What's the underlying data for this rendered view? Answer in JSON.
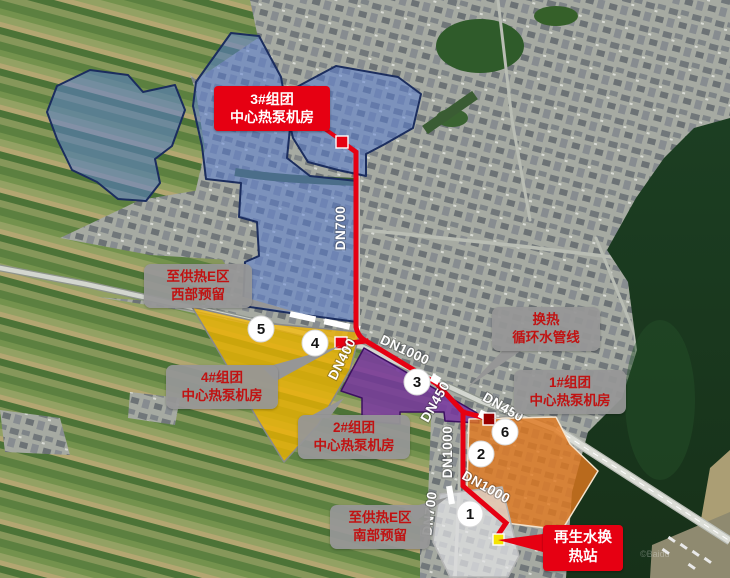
{
  "map": {
    "watermark": "©Baidu",
    "callouts": {
      "hub3": {
        "line1": "3#组团",
        "line2": "中心热泵机房"
      },
      "west_reserved": {
        "line1": "至供热E区",
        "line2": "西部预留"
      },
      "exchange_loop": {
        "line1": "换热",
        "line2": "循环水管线"
      },
      "hub1": {
        "line1": "1#组团",
        "line2": "中心热泵机房"
      },
      "hub4": {
        "line1": "4#组团",
        "line2": "中心热泵机房"
      },
      "hub2": {
        "line1": "2#组团",
        "line2": "中心热泵机房"
      },
      "south_reserved": {
        "line1": "至供热E区",
        "line2": "南部预留"
      },
      "recycled_water": {
        "line1": "再生水换",
        "line2": "热站"
      }
    },
    "pipe_labels": {
      "dn700_north": "DN700",
      "dn400": "DN400",
      "dn1000_mid": "DN1000",
      "dn450_a": "DN450",
      "dn450_b": "DN450",
      "dn1000_vertical": "DN1000",
      "dn1000_south": "DN1000",
      "dn700_south": "DN700"
    },
    "node_numbers": {
      "n1": "1",
      "n2": "2",
      "n3": "3",
      "n4": "4",
      "n5": "5",
      "n6": "6"
    },
    "colors": {
      "pipeline_red": "#e60012",
      "zone_blue": "#5a7dd2",
      "zone_yellow": "#f0b400",
      "zone_purple": "#7837a0",
      "zone_orange": "#e2781e",
      "zone_gray": "#e6e6e8",
      "marker_dark_red": "#990000",
      "marker_yellow": "#f5e400",
      "callout_gray_bg": "#969696",
      "callout_text_red": "#c11212"
    }
  }
}
